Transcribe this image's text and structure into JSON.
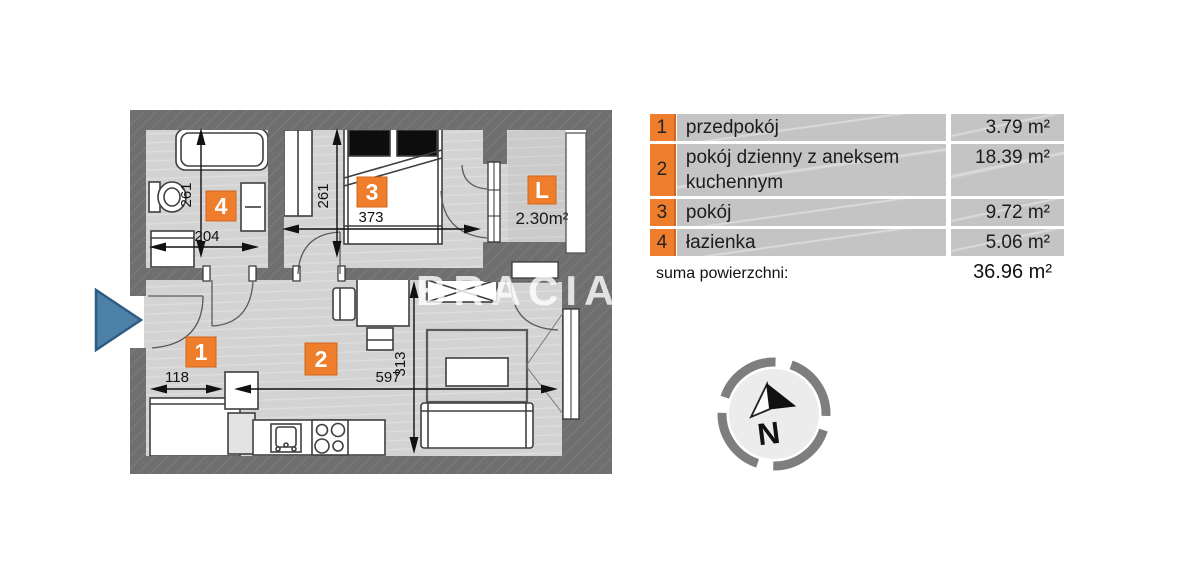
{
  "plan": {
    "watermark": "BRACIA S",
    "badges": {
      "hall": "1",
      "living": "2",
      "bedroom": "3",
      "bathroom": "4",
      "balcony": "L"
    },
    "balcony_area": "2.30m²",
    "dims": {
      "bath_v": "261",
      "bath_h": "204",
      "bed_v": "261",
      "bed_h": "373",
      "hall_w": "118",
      "living_w": "597",
      "living_h": "313"
    }
  },
  "legend": {
    "rows": [
      {
        "num": "1",
        "label": "przedpokój",
        "area": "3.79 m²"
      },
      {
        "num": "2",
        "label": "pokój dzienny z aneksem kuchennym",
        "area": "18.39 m²"
      },
      {
        "num": "3",
        "label": "pokój",
        "area": "9.72 m²"
      },
      {
        "num": "4",
        "label": "łazienka",
        "area": "5.06 m²"
      }
    ],
    "total_label": "suma powierzchni:",
    "total_value": "36.96 m²"
  },
  "compass": {
    "north_label": "N"
  },
  "colors": {
    "badge_orange": "#ee7d2c",
    "wall_gray": "#6f6f6f",
    "floor_gray": "#d3d3d3",
    "entrance_blue": "#4d81a8"
  }
}
